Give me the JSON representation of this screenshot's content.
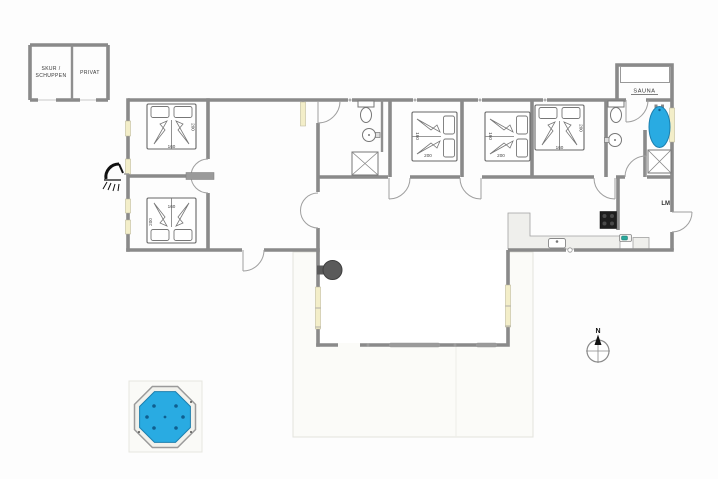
{
  "shed": {
    "room1_line1": "SKUR /",
    "room1_line2": "SCHUPPEN",
    "room2_label": "PRIVAT"
  },
  "sauna": {
    "label": "SAUNA"
  },
  "beds": {
    "width_label": "160",
    "length_label": "200"
  },
  "kitchen": {
    "appliance_label": "LM"
  },
  "compass": {
    "north_label": "N"
  },
  "colors": {
    "wall": "#8a8a8a",
    "window": "#f3eec9",
    "water": "#29abe2",
    "water_edge": "#1c7fae",
    "appliance_text": "#e87820",
    "stove": "#1e1e1e"
  }
}
